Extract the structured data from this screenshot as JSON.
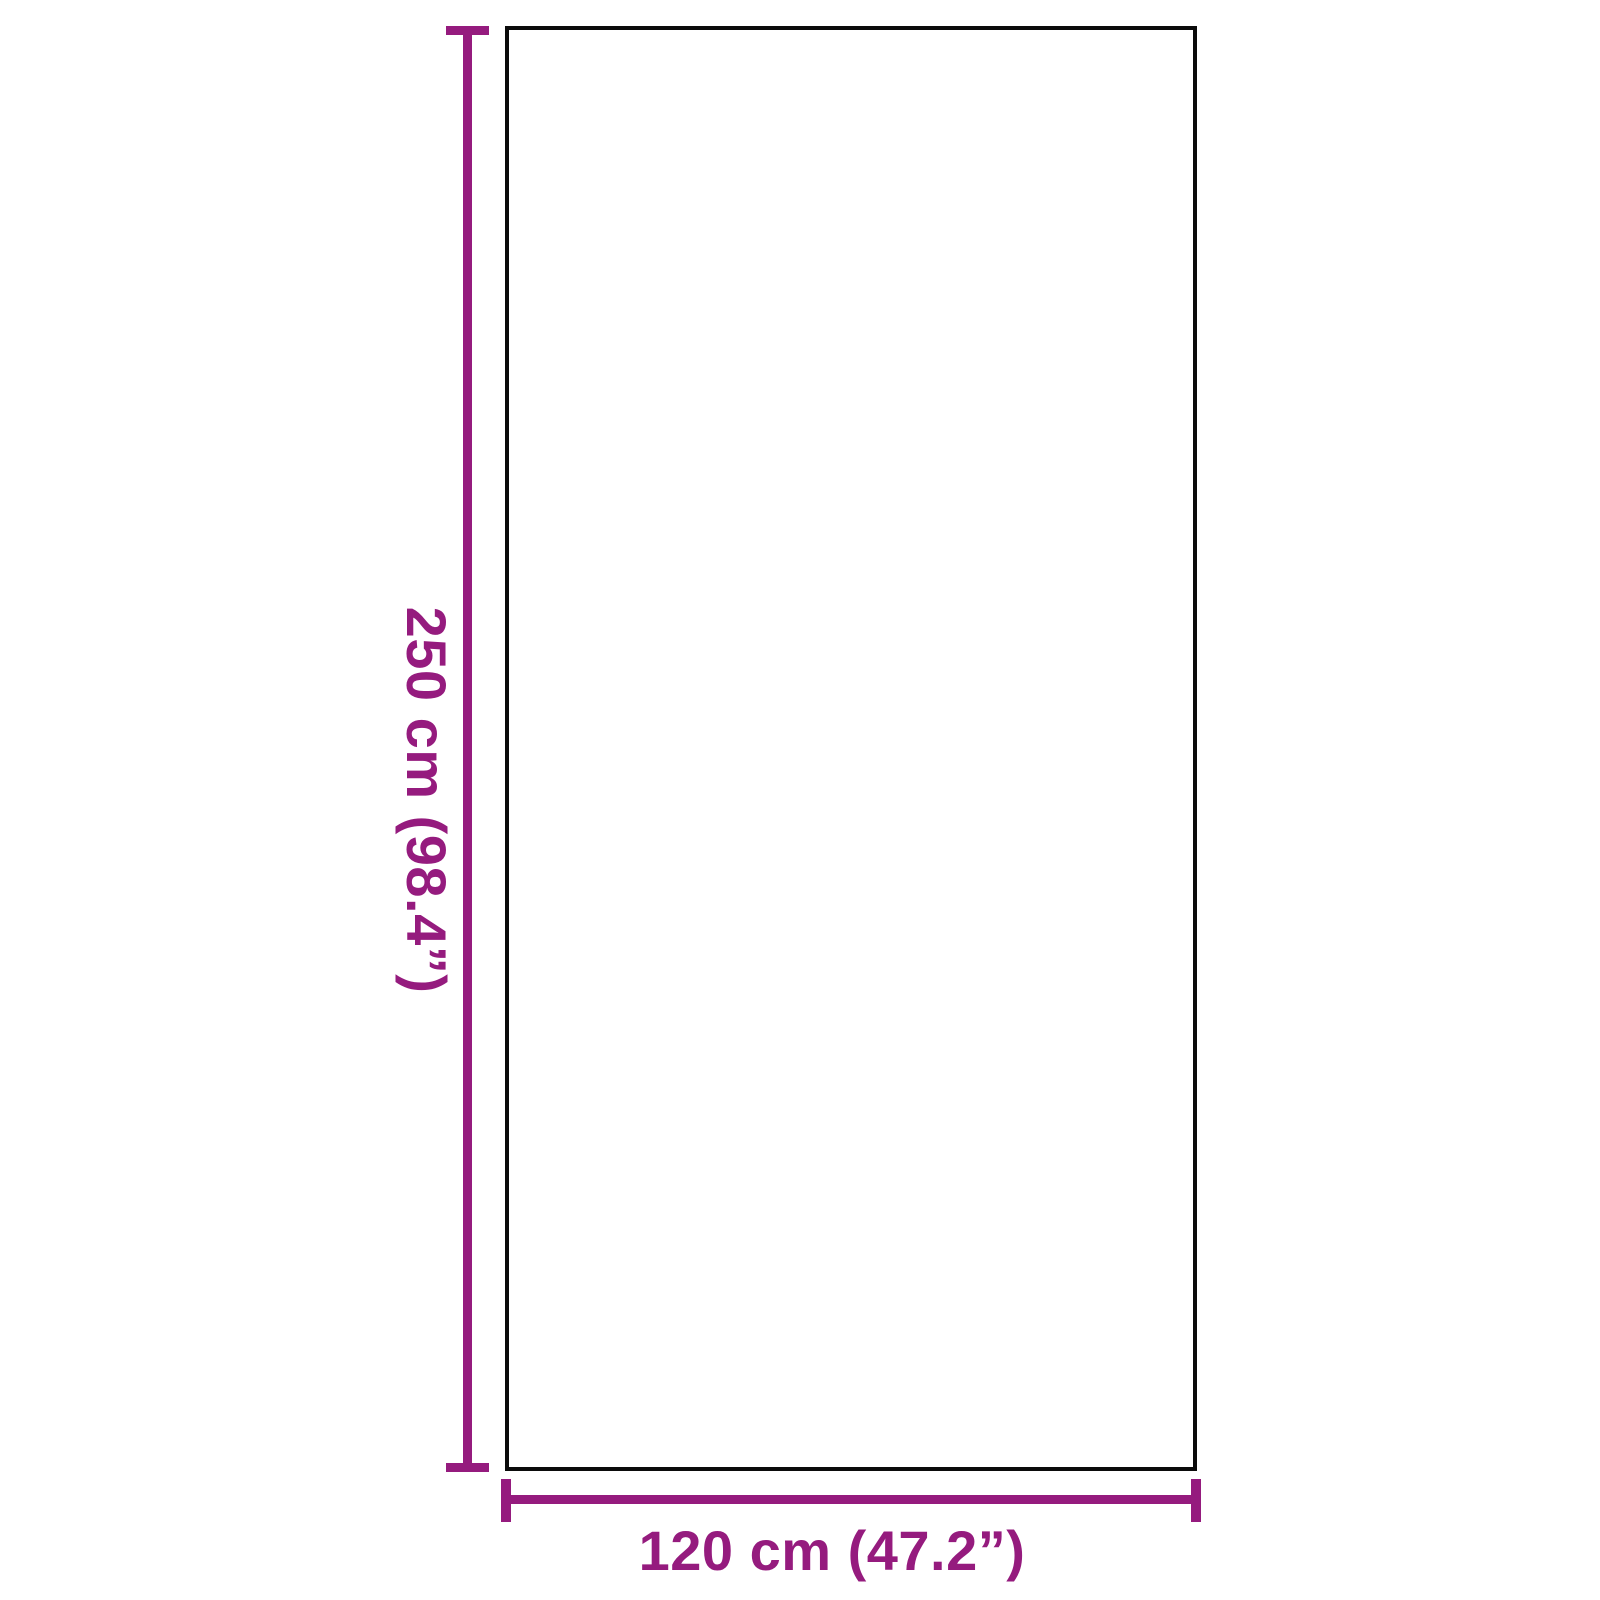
{
  "diagram": {
    "subject": "rectangular-panel-outline",
    "height": {
      "label": "250 cm (98.4”)",
      "cm": 250,
      "inches": 98.4
    },
    "width": {
      "label": "120 cm (47.2”)",
      "cm": 120,
      "inches": 47.2
    },
    "colors": {
      "dimension": "#951B7E",
      "outline": "#0B0B0B",
      "fill": "#FFFFFF",
      "background": "#FFFFFF"
    }
  }
}
